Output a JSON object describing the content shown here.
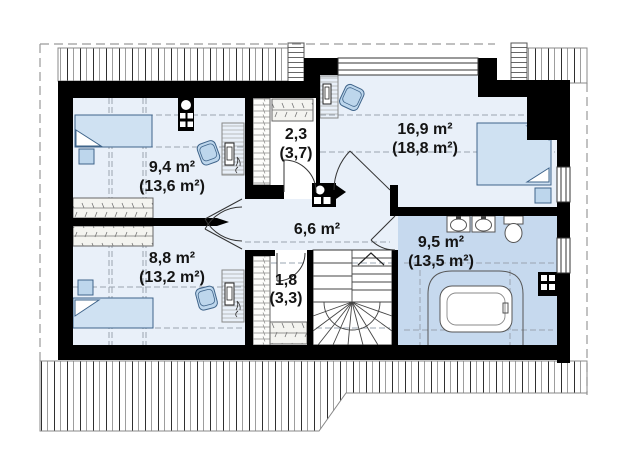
{
  "plan": {
    "type": "attic-floor-plan",
    "rooms": [
      {
        "id": "bedroom-top-left",
        "label": "9,4 m²",
        "label_total": "(13,6 m²)"
      },
      {
        "id": "closet-top",
        "label": "2,3",
        "label_total": "(3,7)"
      },
      {
        "id": "bedroom-top-right",
        "label": "16,9 m²",
        "label_total": "(18,8 m²)"
      },
      {
        "id": "hall",
        "label": "6,6 m²",
        "label_total": ""
      },
      {
        "id": "bedroom-bottom-left",
        "label": "8,8 m²",
        "label_total": "(13,2 m²)"
      },
      {
        "id": "closet-bottom",
        "label": "1,8",
        "label_total": "(3,3)"
      },
      {
        "id": "bathroom",
        "label": "9,5 m²",
        "label_total": "(13,5 m²)"
      }
    ],
    "colors": {
      "wall": "#000000",
      "room_floor": "#e9f0f9",
      "bathroom_floor": "#c6d9ee",
      "furniture_fill": "#bdd6ec",
      "bed_fill": "#cfe1f2",
      "furniture_stroke": "#3f648a",
      "dash_line": "#9aa4b0"
    }
  }
}
